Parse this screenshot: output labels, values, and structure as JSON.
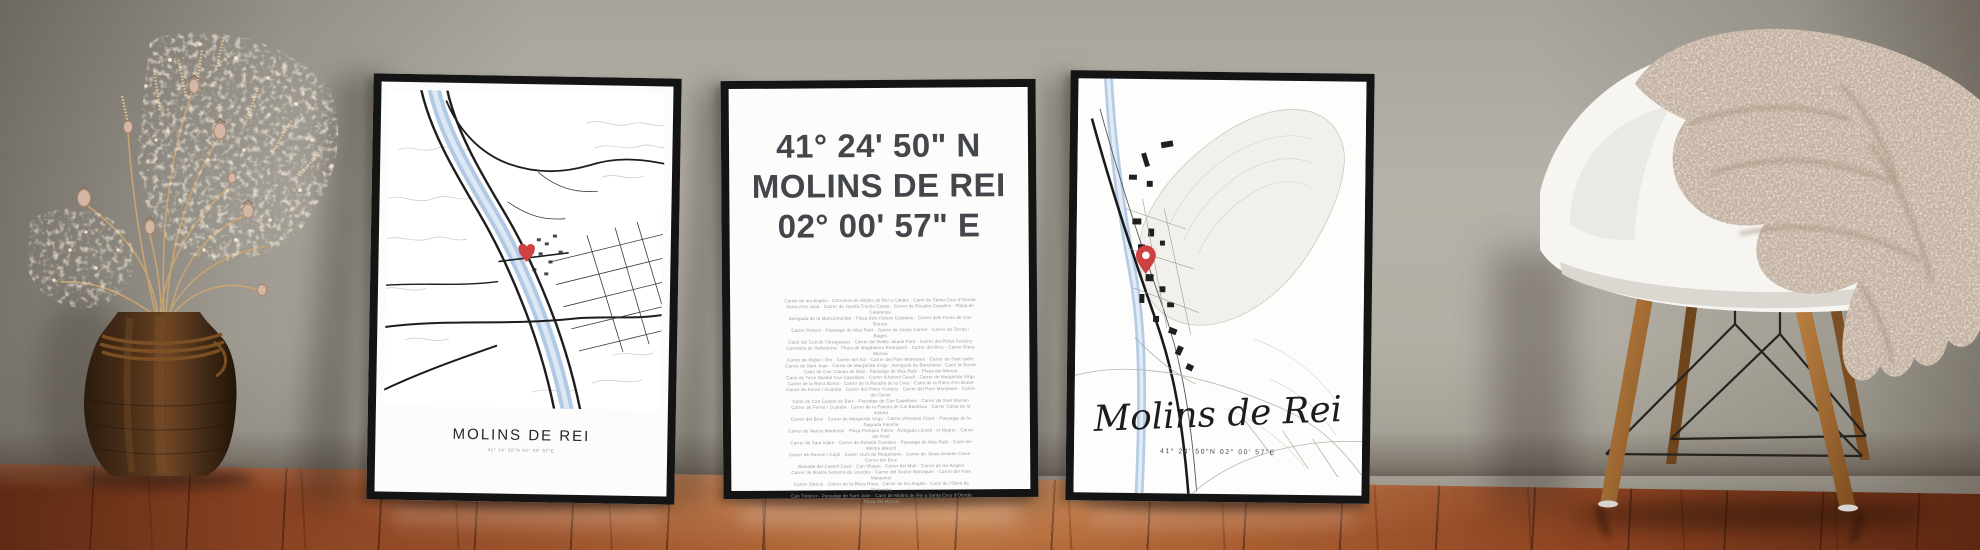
{
  "scene": {
    "wall_color": "#b1ada4",
    "floor_color": "#8a4322",
    "frame_color": "#141414",
    "map_river_blue": "#a9c3e1",
    "marker_red": "#cf4040"
  },
  "poster_left": {
    "title": "MOLINS DE REI",
    "subtitle": "41° 24' 50\"N 02° 00' 57\"E"
  },
  "poster_center": {
    "coord_north": "41° 24' 50\" N",
    "city": "MOLINS DE REI",
    "coord_east": "02° 00' 57\" E",
    "streets": [
      "Carrer de les Anglès · Carretera de Molins de Rei a Caldes · Camí de Santa Creu d'Olorda",
      "Serra d'en Julià · Carrer de Josefa Trechs Casas · Carrer de Rosalia Canalies · Plaça de Catalunya",
      "Avinguda de la Mancomunitat · Plaça dels Països Catalans · Carrer dels Ponts de Can Baruta",
      "Carrer Ponent · Passatge de Mas Rubí · Carrer de Josep Carner · Carrer de Torras i Bages",
      "Camí del Coll de l'Arragossat · Carrer del Batlle Jaume Font · Carrer del Pintor Fortuny",
      "Carretera de Vallvidrera · Plaça de Magdalena Rodríguez · Carrer del Bruc · Carrer Riera Marina",
      "Carrer de Rubió i Ors · Carrer del Sol · Carrer del Pare Manyanet · Carrer de Sant Isidre",
      "Carrer de Sant Joan · Carrer de Margarida Xirgu · Avinguda de Barcelona · Camí la Gireta",
      "Camí de Can Calopa de Baix · Passatge de Mas Rubí · Plaça del Mercat",
      "Camí de Torre Abadal Can Capellans · Carrer d'Antoni Gaudí · Carrer de Margarida Xirgu",
      "Carrer de la Riera Bonet · Carrer de la Rasella de la Creu · Camí de la Riera d'en Bonet",
      "Carrer de Ferrer i Guàrdia · Carrer del Pintor Fortuny · Carrer del Pare Manyanet · Carrer del Gener",
      "Camí de Can Calopa de Baix · Passatge de Can Capellans · Carrer de Sant Ramon",
      "Carrer de Ferrer i Guàrdia · Carrer de la Pineda de Cal Bardissa · Carrer Canal de la Infanta",
      "Carrer del Bruc · Carrer de Margarida Xirgu · Carrer d'Anselm Clavé · Passatge de la Sagrada Família",
      "Carrer de Narcís Monturiol · Plaça Pompeu Fabra · Avinguda Llunell · el Negret · Carrer del Pont",
      "Carrer de Sant Isidre · Carrer de Rosalia Canalies · Passatge de Mas Rubí · Camí del Mestre Blanch",
      "Carrer de Ramon i Cajal · Carrer Lluís de Requesens · Carrer de Josep Anselm Clavé · Carrer del Bruc",
      "Baixada del Castell Ciuró · Can Vilagut · Carrer del Molí · Carrer de les Anglès",
      "Carrer de Nostra Senyora de Lourdes · Carrer del Doctor Barraquer · Carrer del Pare Manyanet",
      "Carrer Sibèria · Carrer de la Riera Rosa · Carrer de les Anglès · Camí de l'Oliva de Sementes",
      "Can Tintorer · Passatge de Sant Joan · Camí de Molins de Rei a Santa Creu d'Olorda",
      "Plaça del Mercat"
    ]
  },
  "poster_right": {
    "title": "Molins de Rei",
    "subtitle": "41° 24' 50\"N 02° 00' 57\"E"
  }
}
